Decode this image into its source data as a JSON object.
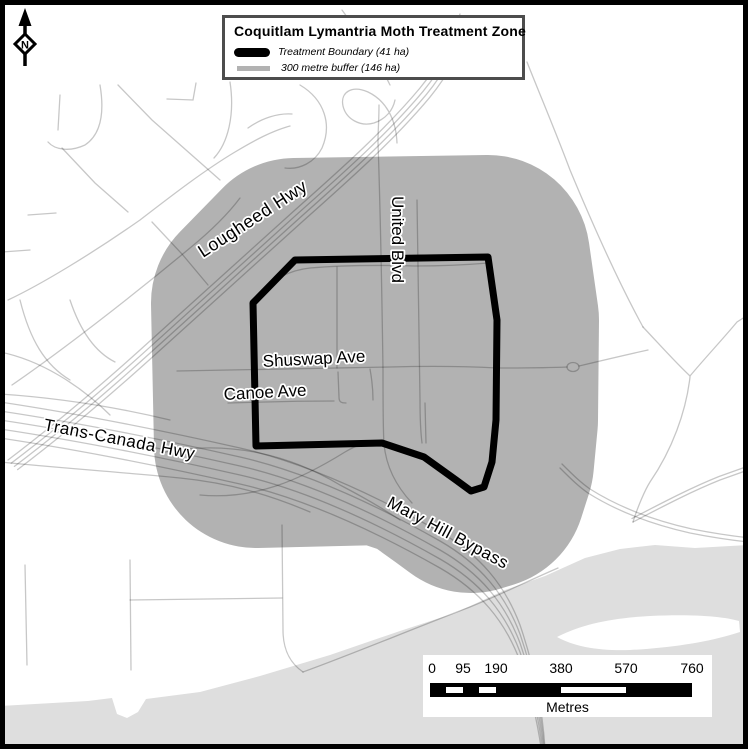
{
  "map": {
    "title": "Coquitlam Lymantria Moth Treatment Zone",
    "legend": {
      "items": [
        {
          "label": "Treatment Boundary (41 ha)"
        },
        {
          "label": "300 metre buffer (146 ha)"
        }
      ]
    },
    "north_arrow": {
      "letter": "N"
    },
    "road_labels": [
      {
        "text": "Lougheed Hwy"
      },
      {
        "text": "United Blvd"
      },
      {
        "text": "Shuswap Ave"
      },
      {
        "text": "Canoe Ave"
      },
      {
        "text": "Trans-Canada Hwy"
      },
      {
        "text": "Mary Hill Bypass"
      }
    ],
    "scale_bar": {
      "ticks": [
        "0",
        "95",
        "190",
        "380",
        "570",
        "760"
      ],
      "unit": "Metres"
    },
    "colors": {
      "buffer": "#b2b2b2",
      "river": "#dedede",
      "boundary": "#000000",
      "road_gray_on_white": "#c6c6c6"
    }
  }
}
